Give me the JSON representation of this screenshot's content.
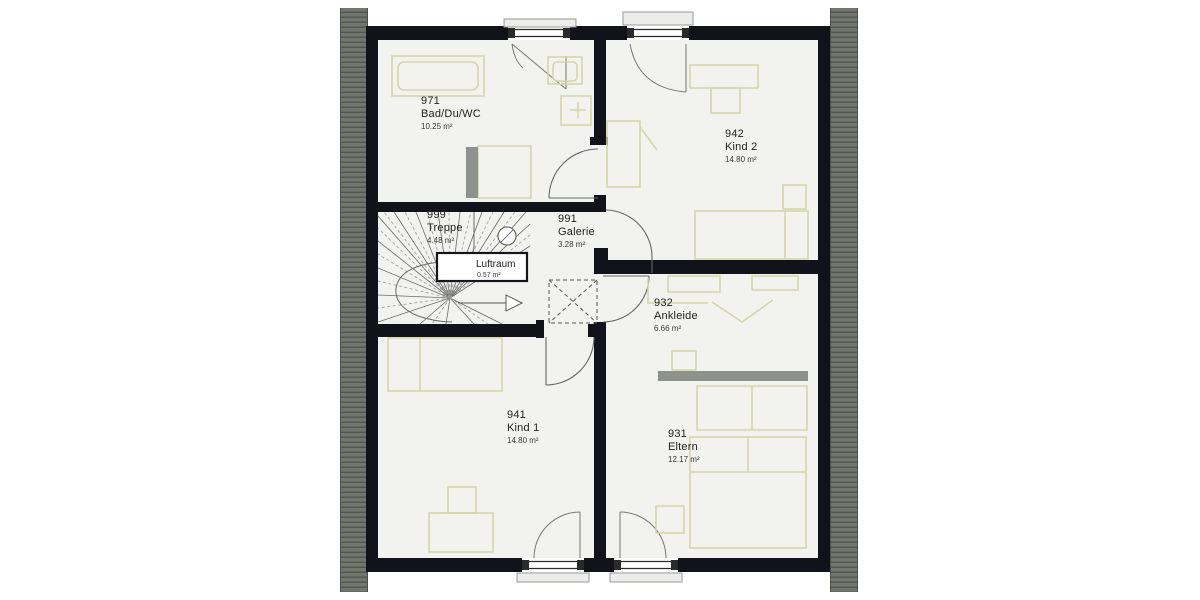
{
  "plan": {
    "rooms": [
      {
        "id": "971",
        "name": "Bad/Du/WC",
        "area": "10.25 m²"
      },
      {
        "id": "942",
        "name": "Kind 2",
        "area": "14.80 m²"
      },
      {
        "id": "999",
        "name": "Treppe",
        "area": "4.48 m²"
      },
      {
        "id": "991",
        "name": "Galerie",
        "area": "3.28 m²"
      },
      {
        "id": "932",
        "name": "Ankleide",
        "area": "6.66 m²"
      },
      {
        "id": "941",
        "name": "Kind 1",
        "area": "14.80 m²"
      },
      {
        "id": "931",
        "name": "Eltern",
        "area": "12.17 m²"
      }
    ],
    "annotations": {
      "luftraum_label": "Luftraum",
      "luftraum_area": "0.57 m²"
    },
    "colors": {
      "wall": "#12121a",
      "floor": "#f2f2ee",
      "furniture_line": "#d4d6a8",
      "roof_hatch": "#73766f",
      "gray_furniture": "#8e918c",
      "background": "#ffffff"
    }
  }
}
